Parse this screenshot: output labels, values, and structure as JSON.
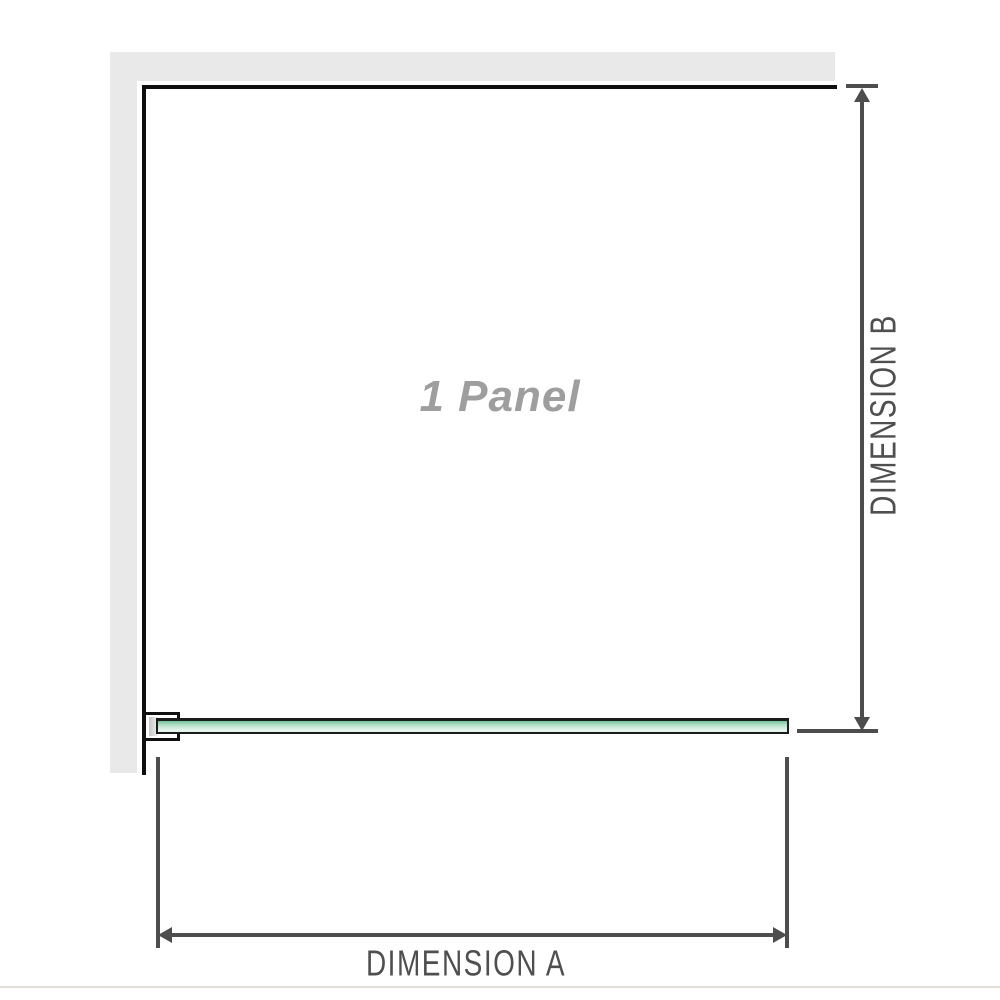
{
  "diagram": {
    "panel_label": "1 Panel",
    "dimensions": {
      "a": {
        "label": "DIMENSION A",
        "orientation": "horizontal"
      },
      "b": {
        "label": "DIMENSION B",
        "orientation": "vertical"
      }
    },
    "colors": {
      "wall_fill": "#e9e9e9",
      "wall_edge": "#0f0f0f",
      "dimension_lines": "#4d4d4d",
      "dimension_text": "#4f4f4f",
      "glass_green_top": "#6fbf95",
      "glass_green_light": "#ecf8f1",
      "panel_label_gray": "#9e9e9e",
      "page_border": "#e0ddd7"
    }
  }
}
